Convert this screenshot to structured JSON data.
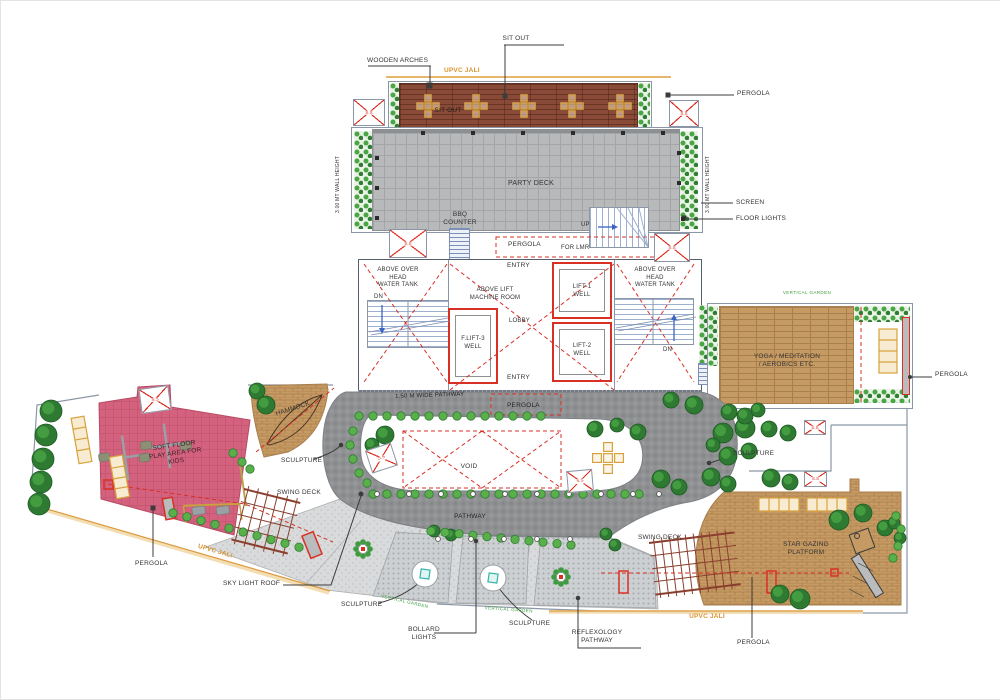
{
  "drawing": {
    "type": "terrace-landscape-architectural-plan",
    "zones": [
      "Sit out terrace",
      "Party deck",
      "Lift lobby level",
      "Yoga / meditation deck",
      "Kids play area",
      "Pathway garden",
      "Star gazing platform"
    ]
  },
  "labels": {
    "sit_out": "SIT OUT",
    "wooden_arches": "WOODEN ARCHES",
    "upvc_jali": "UPVC JALI",
    "pergola": "PERGOLA",
    "wall_height": "3.00 MT WALL HEIGHT",
    "party_deck": "PARTY DECK",
    "bbq_counter": "BBQ\nCOUNTER",
    "screen": "SCREEN",
    "floor_lights": "FLOOR LIGHTS",
    "up": "UP",
    "for_lmr": "FOR LMR",
    "entry": "ENTRY",
    "dn": "DN",
    "overhead_tank": "ABOVE OVER\nHEAD\nWATER TANK",
    "lift_machine": "ABOVE LIFT\nMACHINE ROOM",
    "lift1": "LIFT-1\nWELL",
    "lift2": "LIFT-2\nWELL",
    "flift3": "F.LIFT-3\nWELL",
    "lobby": "LOBBY",
    "yoga": "YOGA / MEDITATION\n/ AEROBICS ETC.",
    "vertical_garden": "VERTICAL GARDEN",
    "pathway_wide": "1.50 M WIDE PATHWAY",
    "void": "VOID",
    "pathway": "PATHWAY",
    "hammock": "HAMMOCK",
    "sculpture": "SCULPTURE",
    "soft_floor": "SOFT FLOOR\nPLAY AREA FOR\nKIDS",
    "swing_deck": "SWING DECK",
    "star_gazing": "STAR GAZING\nPLATFORM",
    "sky_light_roof": "SKY LIGHT ROOF",
    "bollard_lights": "BOLLARD\nLIGHTS",
    "reflexology": "REFLEXOLOGY\nPATHWAY",
    "ss": "S.S"
  },
  "colors": {
    "wood_deck_brown": "#8a4a38",
    "furniture_orange": "#d8a23c",
    "party_tile_gray": "#b7b9bb",
    "pathway_cobble_gray": "#8e9092",
    "play_area_pink": "#d4627e",
    "timber_deck_tan": "#c69a63",
    "shrub_green": "#59b04b",
    "tree_green": "#2f7a33",
    "marker_red": "#d93025",
    "stair_blue": "#3b63c4",
    "jali_orange": "#dc9a3f"
  }
}
